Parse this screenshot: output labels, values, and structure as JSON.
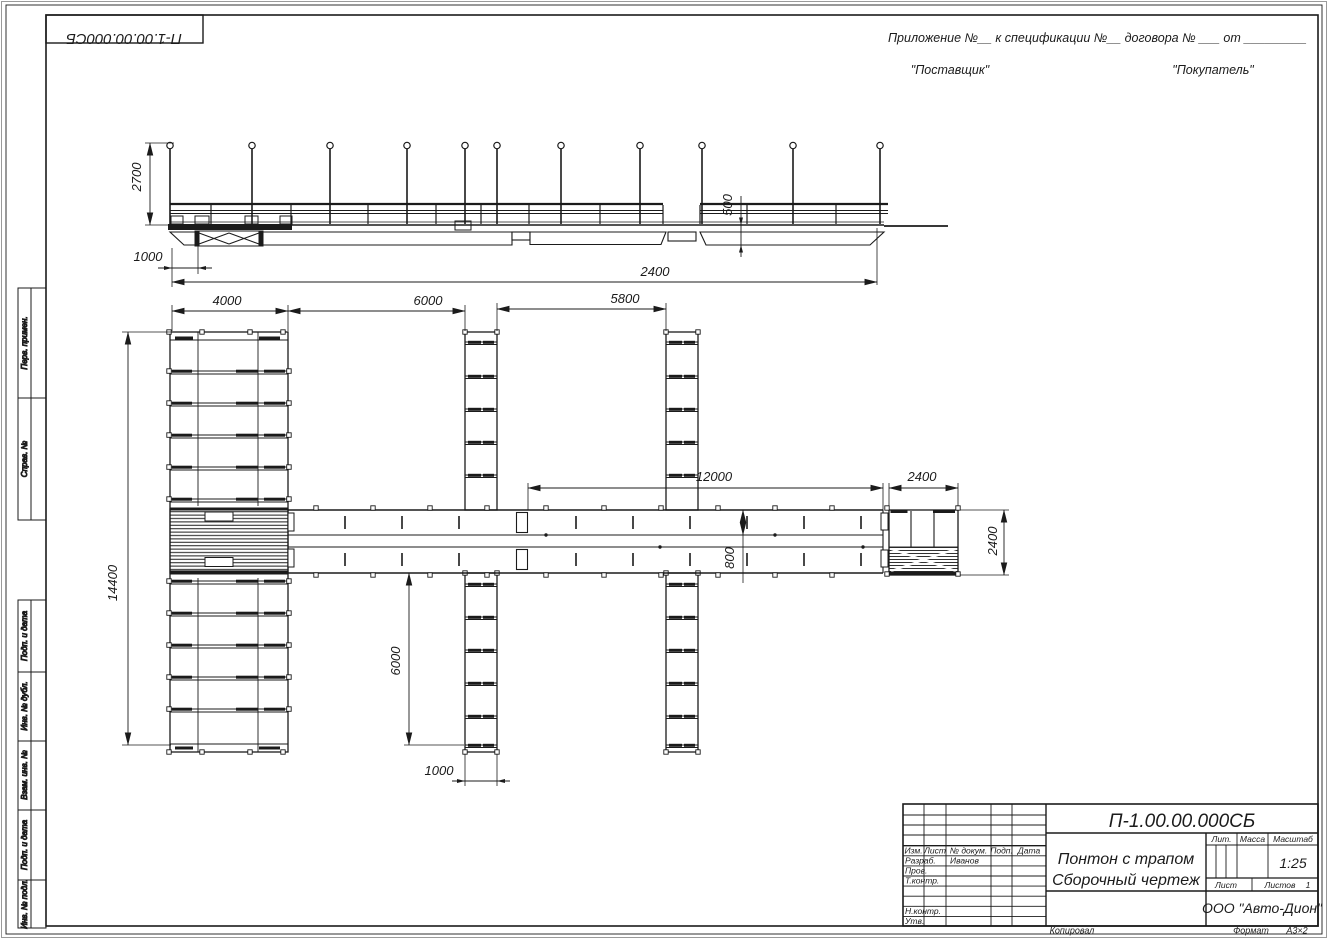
{
  "drawing": {
    "doc_number_top": "П-1.00.00.000СБ",
    "contract_line": "Приложение №__     к спецификации №__    договора № ___  от _________",
    "supplier": "\"Поставщик\"",
    "buyer": "\"Покупатель\""
  },
  "side_strips": {
    "perv": "Перв. примен.",
    "sprav": "Справ. №",
    "podp1": "Подп. и дата",
    "inv_dubl": "Инв. № дубл.",
    "vzam": "Взам. инв. №",
    "podp2": "Подп. и дата",
    "inv_podl": "Инв. № подл."
  },
  "title_block": {
    "doc_number": "П-1.00.00.000СБ",
    "title_line1": "Понтон с трапом",
    "title_line2": "Сборочный чертеж",
    "col_izm": "Изм.",
    "col_list": "Лист",
    "col_doc": "№ докум.",
    "col_podp": "Подп.",
    "col_data": "Дата",
    "row_razrab": "Разраб.",
    "razrab_name": "Иванов",
    "row_prov": "Пров.",
    "row_tkontr": "Т.контр.",
    "row_nkontr": "Н.контр.",
    "row_utv": "Утв.",
    "lit": "Лит.",
    "massa": "Масса",
    "masshtab": "Масштаб",
    "scale": "1:25",
    "list": "Лист",
    "listov": "Листов",
    "listov_value": "1",
    "company": "ООО \"Авто-Дион\"",
    "kopiroval": "Копировал",
    "format_label": "Формат",
    "format_value": "А3×2"
  },
  "dims": {
    "post_height": "2700",
    "ramp_offset": "1000",
    "side_length": "2400",
    "hull_height": "500",
    "pier_width": "4000",
    "bay1": "6000",
    "bay2": "5800",
    "walkway_length": "12000",
    "platform_width": "2400",
    "pier_length": "14400",
    "walkway_width": "800",
    "finger_length": "6000",
    "finger_width": "1000",
    "platform_depth": "2400"
  }
}
